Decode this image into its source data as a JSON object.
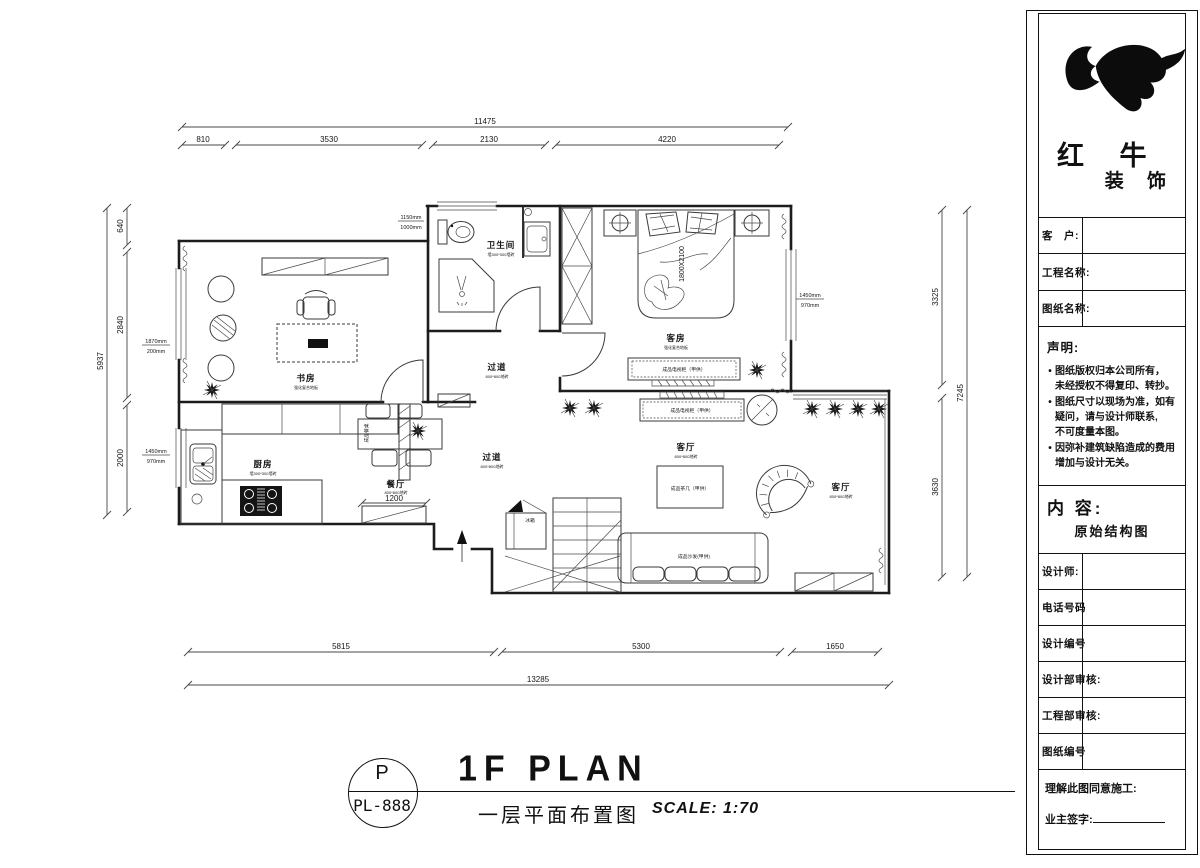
{
  "page": {
    "background": "#ffffff",
    "ink": "#000000"
  },
  "stamp": {
    "letter": "P",
    "code": "PL-888"
  },
  "titlebar": {
    "title": "1F PLAN",
    "subtitle": "一层平面布置图",
    "scale": "SCALE: 1:70"
  },
  "dims": {
    "top": {
      "overall": "11475",
      "segments": [
        "810",
        "3530",
        "2130",
        "4220"
      ]
    },
    "bottom": {
      "overall": "13285",
      "segments": [
        "5815",
        "5300",
        "1650"
      ]
    },
    "left": {
      "overall": "5937",
      "segments": [
        "640",
        "2840",
        "2000"
      ]
    },
    "right": {
      "overall": "7245",
      "segments": [
        "3325",
        "3630"
      ]
    },
    "cabinet_width": "1200",
    "bed_size": "1800X2100",
    "win_top": {
      "a": "1150mm",
      "b": "1000mm"
    },
    "win_left_upper": {
      "a": "1870mm",
      "b": "200mm"
    },
    "win_left_lower": {
      "a": "1450mm",
      "b": "970mm"
    },
    "win_right_bedroom": {
      "a": "1450mm",
      "b": "970mm"
    }
  },
  "rooms": {
    "study": {
      "name": "书房",
      "note": "强化复合地板"
    },
    "bath": {
      "name": "卫生间",
      "note": "墙300*300墙砖"
    },
    "hall_upper": {
      "name": "过道",
      "note": "800*800地砖"
    },
    "guest": {
      "name": "客房",
      "note": "强化复合地板"
    },
    "hall_lower": {
      "name": "过道",
      "note": "800*800地砖"
    },
    "kitchen": {
      "name": "厨房",
      "note": "墙300*300墙砖"
    },
    "dining": {
      "name": "餐厅",
      "note": "800*800地砖"
    },
    "living_center": {
      "name": "客厅",
      "note": "800*800地砖"
    },
    "living_right": {
      "name": "客厅",
      "note": "800*800地砖"
    }
  },
  "furniture": {
    "tv_cabinet_guest": "成品电视柜（甲供）",
    "tv_cabinet_living": "成品电视柜（甲供）",
    "coffee_table": "成品茶几（甲供）",
    "sofa": "成品沙发(甲供)",
    "dining_table": "成品餐桌",
    "fridge": "冰箱"
  },
  "title_block": {
    "brand_top": "红 牛",
    "brand_bottom": "装 饰",
    "bullet_char": "•",
    "fields": [
      {
        "label": "客　户:"
      },
      {
        "label": "工程名称:"
      },
      {
        "label": "图纸名称:"
      }
    ],
    "statement_heading": "声明:",
    "statement": [
      {
        "l1": "图纸版权归本公司所有，",
        "l2": "未经授权不得复印、转抄。"
      },
      {
        "l1": "图纸尺寸以现场为准，如有",
        "l2": "疑问，请与设计师联系,",
        "l3": "不可度量本图。"
      },
      {
        "l1": "因弥补建筑缺陷造成的费用",
        "l2": "增加与设计无关。"
      }
    ],
    "content_heading": "内 容:",
    "content_value": "原始结构图",
    "rows": [
      {
        "label": "设计师:"
      },
      {
        "label": "电话号码"
      },
      {
        "label": "设计编号"
      },
      {
        "label": "设计部审核:"
      },
      {
        "label": "工程部审核:"
      },
      {
        "label": "图纸编号"
      }
    ],
    "approve_line": "理解此图同意施工:",
    "sign_line": "业主签字:"
  }
}
